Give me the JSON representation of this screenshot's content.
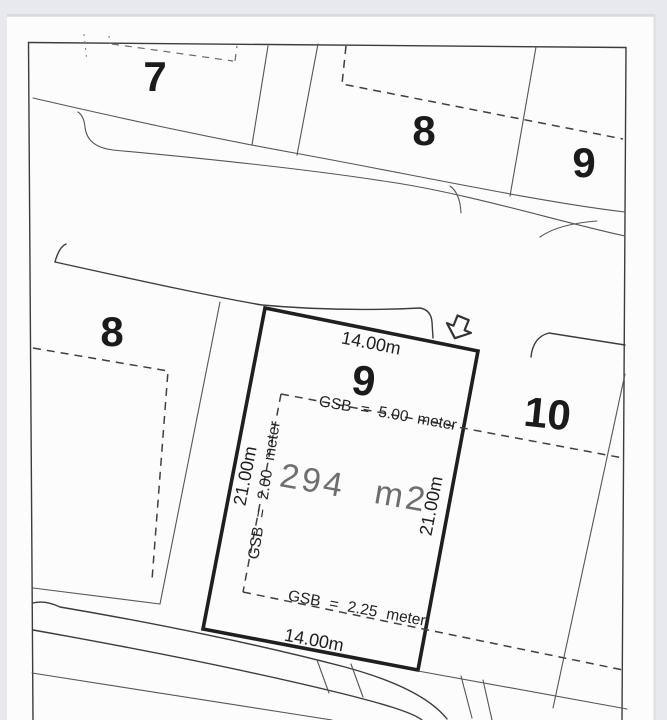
{
  "document": {
    "kind": "scanned site plan / plot layout drawing"
  },
  "colors": {
    "background": "#e8e9ee",
    "paper": "#fcfcfd",
    "ink": "#3c3c3c",
    "plot_border": "#1f1f1f",
    "area_text": "#6e6e6e"
  },
  "plan": {
    "top_row": {
      "plot7_label": "7",
      "plot8_label": "8",
      "plot9_label": "9"
    },
    "left_plot": {
      "number": "8"
    },
    "main_plot": {
      "number": "9",
      "area_label": "294 m2",
      "front_width": "14.00m",
      "rear_width": "14.00m",
      "left_depth": "21.00m",
      "right_depth": "21.00m",
      "gsb_front": "GSB = 5.00 meter",
      "gsb_side": "GSB = 2.00 meter",
      "gsb_rear": "GSB = 2.25 meter"
    },
    "right_plot": {
      "number": "10"
    },
    "icons": {
      "entrance_arrow": "hollow-down-arrow"
    }
  }
}
